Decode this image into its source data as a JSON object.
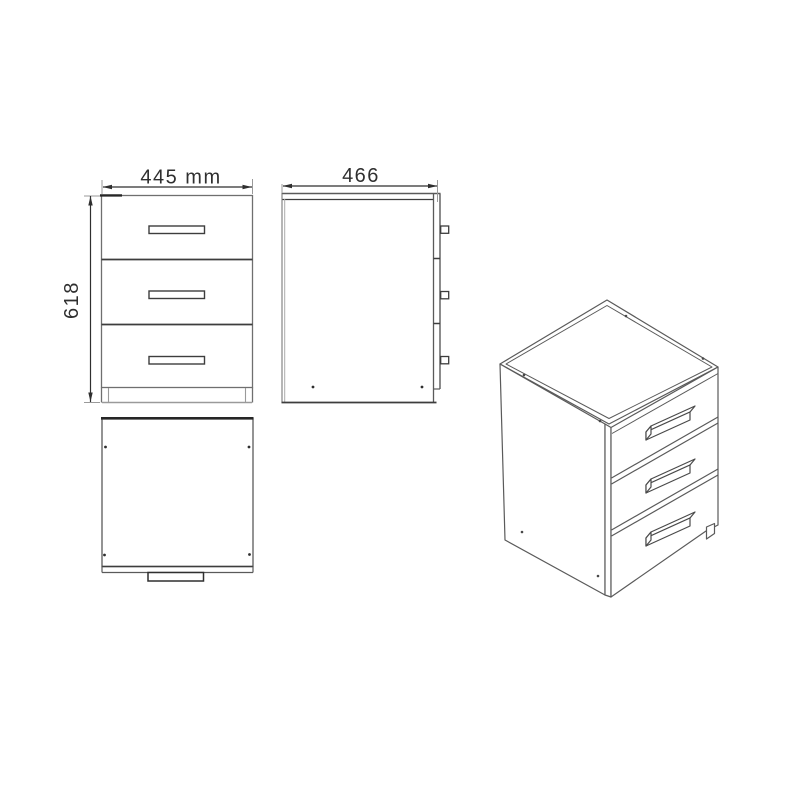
{
  "diagram": {
    "subject": "three-drawer-cabinet-technical-drawing",
    "labels": {
      "width": "445 mm",
      "depth": "466",
      "height": "618"
    },
    "views": {
      "front": {
        "drawer_count": 3,
        "handle_count": 3
      },
      "side": {
        "handle_count": 3
      },
      "top": {
        "handle_count": 1
      },
      "perspective": {
        "drawer_count": 3,
        "handle_count": 3,
        "foot_count": 1
      }
    },
    "colors": {
      "background": "#ffffff",
      "line_dark": "#2f2f2f",
      "line_medium": "#5a5a5a",
      "line_light": "#9a9a9a"
    }
  }
}
